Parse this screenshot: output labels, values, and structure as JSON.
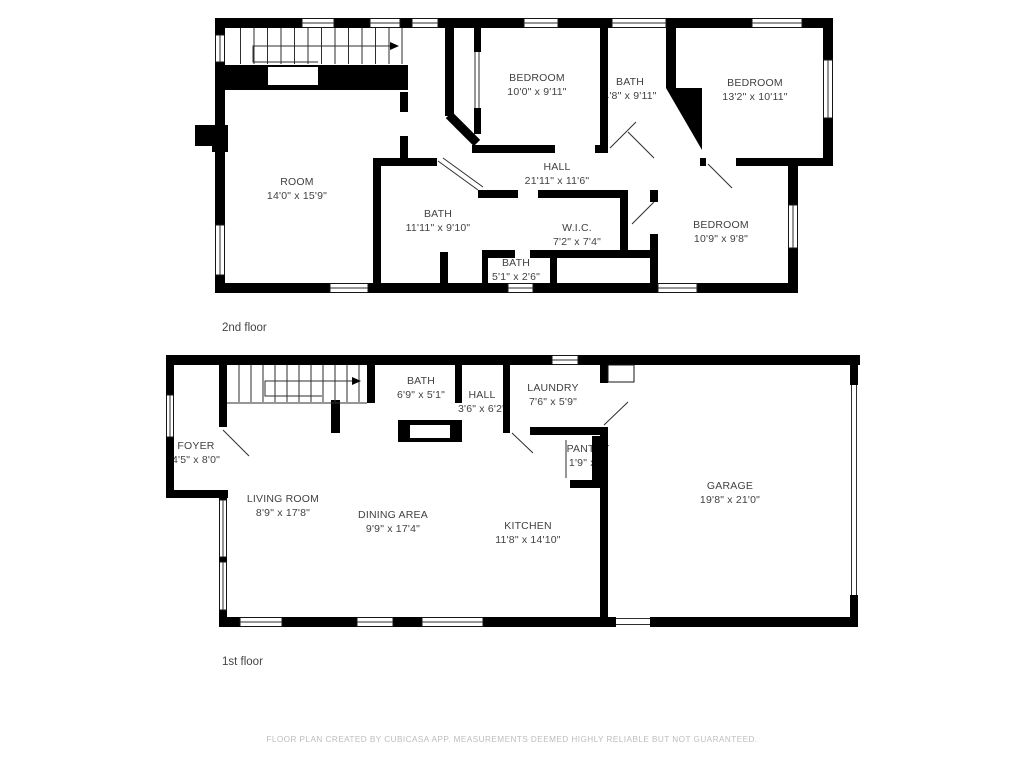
{
  "floors": [
    {
      "label": "2nd floor",
      "rooms": [
        {
          "name": "BEDROOM",
          "dims": "10'0\" x 9'11\""
        },
        {
          "name": "BATH",
          "dims": "4'8\" x 9'11\""
        },
        {
          "name": "BEDROOM",
          "dims": "13'2\" x 10'11\""
        },
        {
          "name": "ROOM",
          "dims": "14'0\" x 15'9\""
        },
        {
          "name": "HALL",
          "dims": "21'11\" x 11'6\""
        },
        {
          "name": "BATH",
          "dims": "11'11\" x 9'10\""
        },
        {
          "name": "W.I.C.",
          "dims": "7'2\" x 7'4\""
        },
        {
          "name": "BATH",
          "dims": "5'1\" x 2'6\""
        },
        {
          "name": "BEDROOM",
          "dims": "10'9\" x 9'8\""
        }
      ]
    },
    {
      "label": "1st floor",
      "rooms": [
        {
          "name": "FOYER",
          "dims": "4'5\" x 8'0\""
        },
        {
          "name": "BATH",
          "dims": "6'9\" x 5'1\""
        },
        {
          "name": "HALL",
          "dims": "3'6\" x 6'2\""
        },
        {
          "name": "LAUNDRY",
          "dims": "7'6\" x 5'9\""
        },
        {
          "name": "PANTRY",
          "dims": "1'9\" x 2'"
        },
        {
          "name": "LIVING ROOM",
          "dims": "8'9\" x 17'8\""
        },
        {
          "name": "DINING AREA",
          "dims": "9'9\" x 17'4\""
        },
        {
          "name": "KITCHEN",
          "dims": "11'8\" x 14'10\""
        },
        {
          "name": "GARAGE",
          "dims": "19'8\" x 21'0\""
        }
      ]
    }
  ],
  "footer": {
    "text": "FLOOR PLAN CREATED BY CUBICASA APP. MEASUREMENTS DEEMED HIGHLY RELIABLE BUT NOT GUARANTEED."
  },
  "colors": {
    "background_color": "#ffffff",
    "wall_color": "#000000",
    "room_text_color": "#414141",
    "floor_label_color": "#454545",
    "footer_text_color": "#bdbdbd",
    "window_stroke_color": "#161616",
    "thin_line_color": "#2e2e2e"
  }
}
